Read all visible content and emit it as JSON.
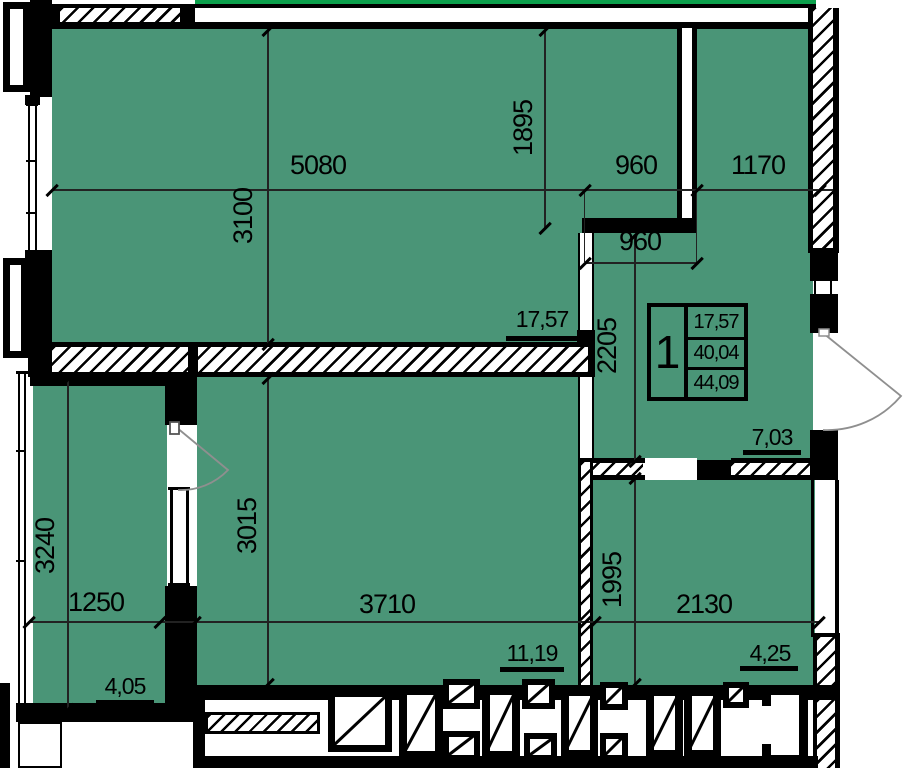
{
  "title": "apartment floor plan, 1-room unit",
  "colors": {
    "room_fill": "#4a9577",
    "boundary_green": "#0ca04c",
    "wall": "#000000",
    "dim_text": "#000000",
    "door_arc": "#8f8f8f"
  },
  "unit_box": {
    "room_count": "1",
    "living_area": "17,57",
    "apartment_area": "40,04",
    "total_area": "44,09"
  },
  "areas": {
    "living_room": "17,57",
    "hall": "7,03",
    "bedroom": "11,19",
    "bathroom": "4,25",
    "balcony": "4,05"
  },
  "dims": {
    "main_width": "5080",
    "main_height": "3100",
    "niche_height": "1895",
    "niche_width": "960",
    "right_top_width": "1170",
    "niche_opening": "960",
    "hall_height": "2205",
    "bedroom_width": "3710",
    "bedroom_height": "3015",
    "bath_width": "2130",
    "bath_height": "1995",
    "balcony_width": "1250",
    "balcony_height": "3240"
  }
}
